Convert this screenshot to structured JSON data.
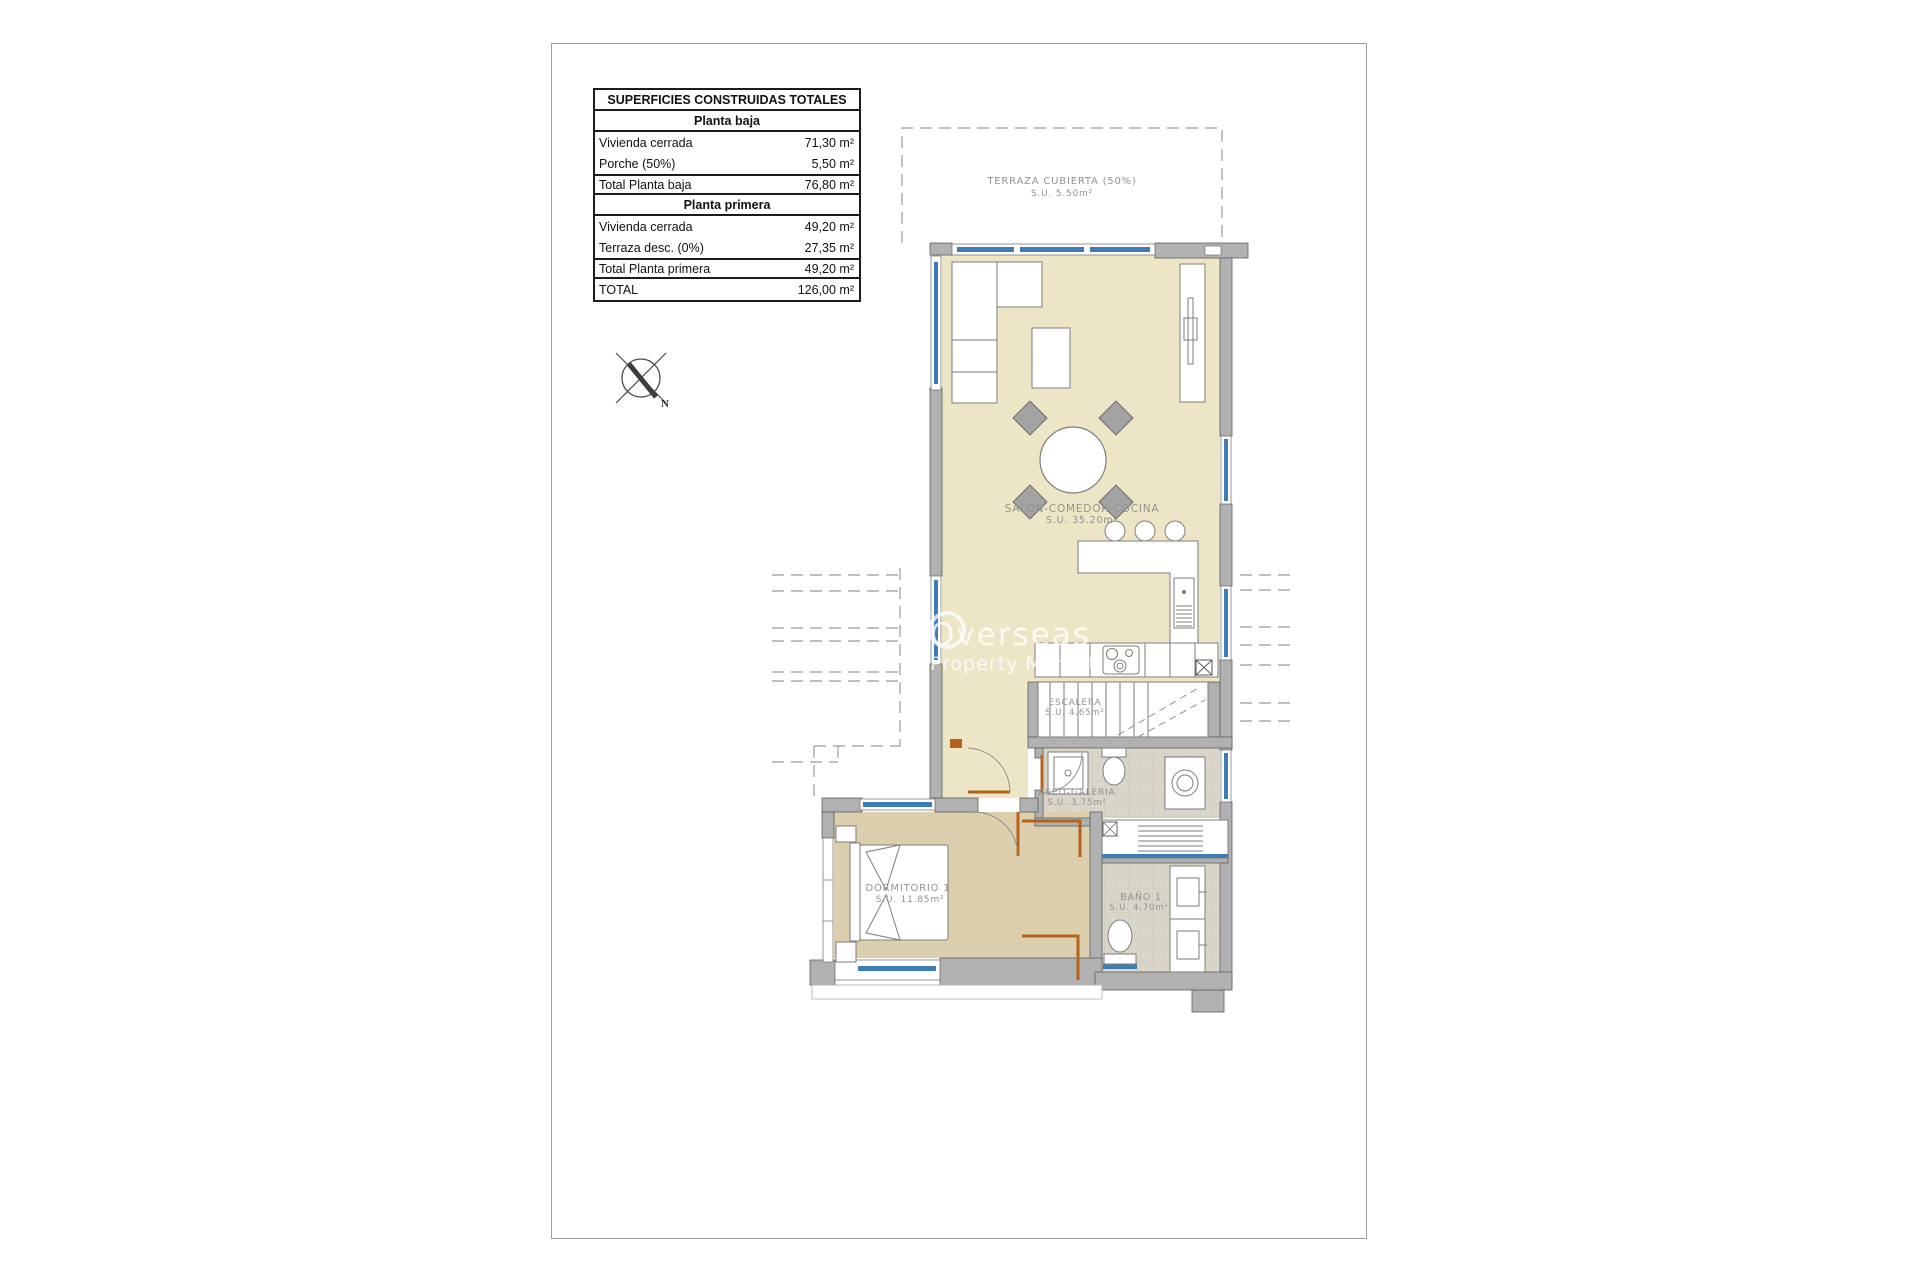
{
  "colors": {
    "wall-color": "#b1b1b1",
    "floor-main": "#ece6c6",
    "floor-bedroom": "#dbcfad",
    "floor-wet": "#d9d5c8",
    "window-color": "#3d7cb4",
    "door-color": "#b5621c"
  },
  "areas_table": {
    "title": "SUPERFICIES CONSTRUIDAS TOTALES",
    "section1": {
      "header": "Planta baja",
      "row1": {
        "label": "Vivienda cerrada",
        "value": "71,30 m²"
      },
      "row2": {
        "label": "Porche (50%)",
        "value": "5,50 m²"
      },
      "total": {
        "label": "Total Planta baja",
        "value": "76,80 m²"
      }
    },
    "section2": {
      "header": "Planta primera",
      "row1": {
        "label": "Vivienda cerrada",
        "value": "49,20 m²"
      },
      "row2": {
        "label": "Terraza desc. (0%)",
        "value": "27,35 m²"
      },
      "total": {
        "label": "Total Planta primera",
        "value": "49,20 m²"
      }
    },
    "grand_total": {
      "label": "TOTAL",
      "value": "126,00 m²"
    }
  },
  "rooms": {
    "terraza": {
      "name": "TERRAZA CUBIERTA (50%)",
      "area": "S.U. 5.50m²"
    },
    "salon": {
      "name": "SALÓN-COMEDOR-COCINA",
      "area": "S.U. 35.20m²"
    },
    "escalera": {
      "name": "ESCALERA",
      "area": "S.U. 4.65m²"
    },
    "aseo": {
      "name": "ASEO-GALERIA",
      "area": "S.U. 3.75m²"
    },
    "dormitorio": {
      "name": "DORMITORIO 1",
      "area": "S.U. 11.85m²"
    },
    "bano": {
      "name": "BAÑO 1",
      "area": "S.U. 4.70m²"
    }
  },
  "compass": {
    "north_label": "N"
  },
  "watermark": {
    "brand": "Overseas",
    "tagline": "Property Market"
  }
}
